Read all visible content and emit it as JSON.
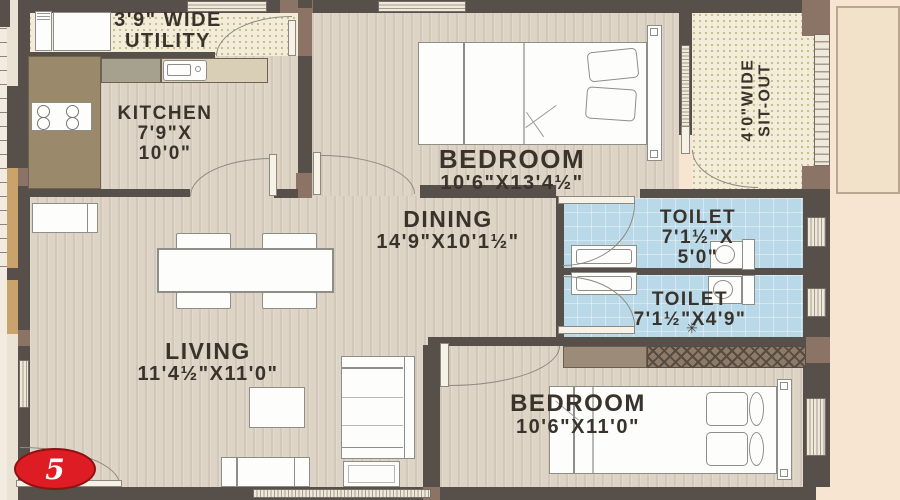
{
  "unit": {
    "marker": "5"
  },
  "rooms": {
    "utility": {
      "l1": "3'9\" WIDE",
      "l2": "UTILITY"
    },
    "kitchen": {
      "l1": "KITCHEN",
      "l2": "7'9\"X",
      "l3": "10'0\""
    },
    "bedroom1": {
      "l1": "BEDROOM",
      "l2": "10'6\"X13'4½\""
    },
    "sitout": {
      "l1": "4'0\"WIDE",
      "l2": "SIT-OUT"
    },
    "dining": {
      "l1": "DINING",
      "l2": "14'9\"X10'1½\""
    },
    "toilet1": {
      "l1": "TOILET",
      "l2": "7'1½\"X",
      "l3": "5'0\""
    },
    "toilet2": {
      "l1": "TOILET",
      "l2": "7'1½\"X4'9\""
    },
    "living": {
      "l1": "LIVING",
      "l2": "11'4½\"X11'0\""
    },
    "bedroom2": {
      "l1": "BEDROOM",
      "l2": "10'6\"X11'0\""
    }
  },
  "colors": {
    "wall": "#57504a",
    "wall_accent": "#8b7365",
    "toilet_floor": "#b9d9e8",
    "wood_floor": "#ded4c6",
    "dotted_floor": "#f3ecd8",
    "outside": "#f8e5d1",
    "marker_red": "#de1c23"
  }
}
